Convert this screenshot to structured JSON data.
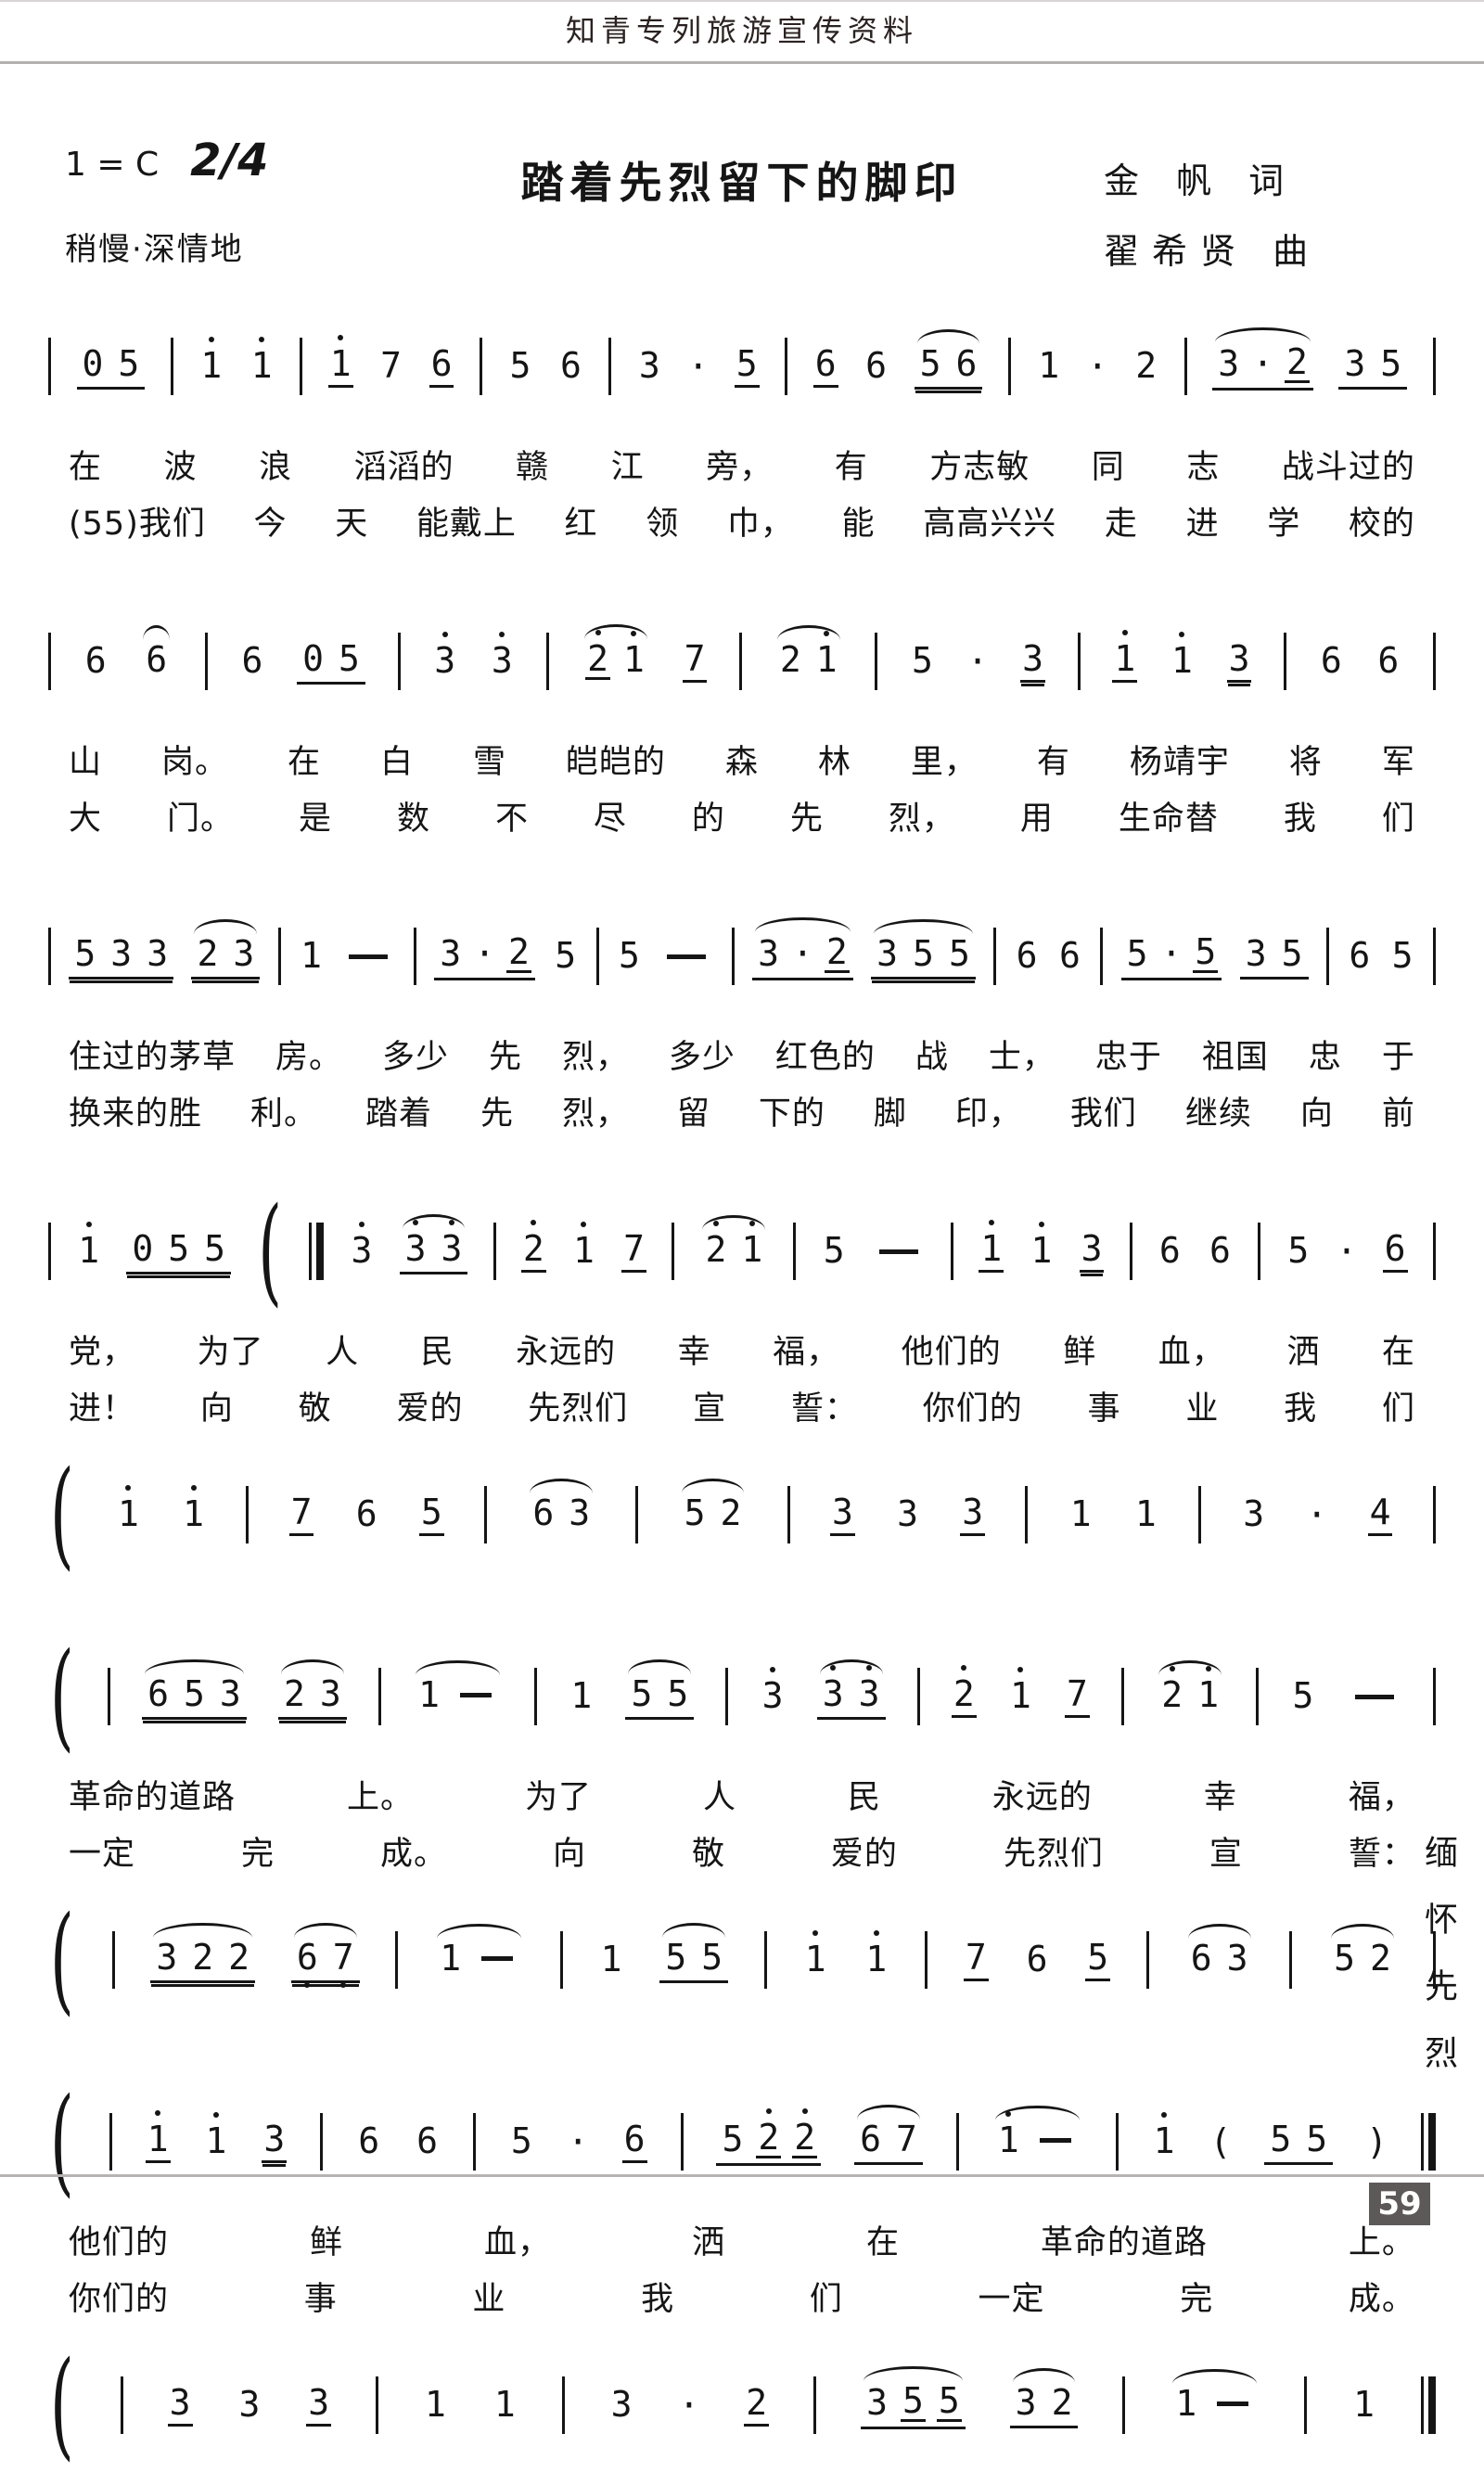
{
  "page": {
    "header": "知青专列旅游宣传资料",
    "margin_note": "缅怀先烈",
    "page_number": "59"
  },
  "colors": {
    "ink": "#151515",
    "rule_gray": "#b5b0b0",
    "page_number_bg": "#5e5959",
    "page_number_fg": "#ffffff"
  },
  "title_block": {
    "key": "1 = C",
    "meter": "2/4",
    "tempo": "稍慢·深情地",
    "title": "踏着先烈留下的脚印",
    "lyricist": "金 帆 词",
    "composer": "翟希贤 曲"
  },
  "systems": [
    {
      "voice1": [
        {
          "b": 1
        },
        {
          "g": [
            {
              "n": "0"
            },
            {
              "n": "5"
            }
          ],
          "u": 1
        },
        {
          "b": 1
        },
        {
          "n": "1",
          "o": 1
        },
        {
          "n": "1",
          "o": 1
        },
        {
          "b": 1
        },
        {
          "n": "1",
          "o": 1,
          "u": 1
        },
        {
          "n": "7"
        },
        {
          "n": "6",
          "u": 1
        },
        {
          "b": 1
        },
        {
          "n": "5"
        },
        {
          "n": "6"
        },
        {
          "b": 1
        },
        {
          "n": "3"
        },
        {
          "c": "·"
        },
        {
          "n": "5",
          "u": 1
        },
        {
          "b": 1
        },
        {
          "n": "6",
          "u": 1
        },
        {
          "n": "6"
        },
        {
          "g": [
            {
              "n": "5"
            },
            {
              "n": "6"
            }
          ],
          "u": 2,
          "arc": true
        },
        {
          "b": 1
        },
        {
          "n": "1"
        },
        {
          "c": "·"
        },
        {
          "n": "2"
        },
        {
          "b": 1
        },
        {
          "g": [
            {
              "n": "3"
            },
            {
              "c": "·"
            },
            {
              "n": "2",
              "u": 1
            }
          ],
          "u": 1,
          "arc": true
        },
        {
          "g": [
            {
              "n": "3"
            },
            {
              "n": "5"
            }
          ],
          "u": 1
        },
        {
          "b": 1
        }
      ],
      "lyrics1": [
        "在",
        "波",
        "浪",
        "滔滔的",
        "赣",
        "江",
        "旁，",
        "有",
        "方志敏",
        "同",
        "志",
        "战斗过的"
      ],
      "lyrics2": [
        "(55)我们",
        "今",
        "天",
        "能戴上",
        "红",
        "领",
        "巾，",
        "能",
        "高高兴兴",
        "走",
        "进",
        "学",
        "校的"
      ]
    },
    {
      "voice1": [
        {
          "b": 1
        },
        {
          "n": "6"
        },
        {
          "g": [
            {
              "n": "6"
            }
          ],
          "arc": true
        },
        {
          "b": 1
        },
        {
          "n": "6"
        },
        {
          "g": [
            {
              "n": "0"
            },
            {
              "n": "5"
            }
          ],
          "u": 1
        },
        {
          "b": 1
        },
        {
          "n": "3",
          "o": 1
        },
        {
          "n": "3",
          "o": 1
        },
        {
          "b": 1
        },
        {
          "g": [
            {
              "n": "2",
              "o": 1,
              "u": 1
            },
            {
              "n": "1",
              "o": 1
            }
          ],
          "arc": true
        },
        {
          "n": "7",
          "u": 1
        },
        {
          "b": 1
        },
        {
          "g": [
            {
              "n": "2"
            },
            {
              "n": "1",
              "o": 1
            }
          ],
          "arc": true
        },
        {
          "b": 1
        },
        {
          "n": "5"
        },
        {
          "c": "·"
        },
        {
          "n": "3",
          "u": 2
        },
        {
          "b": 1
        },
        {
          "n": "1",
          "o": 1,
          "u": 1
        },
        {
          "n": "1",
          "o": 1
        },
        {
          "n": "3",
          "u": 2
        },
        {
          "b": 1
        },
        {
          "n": "6"
        },
        {
          "n": "6"
        },
        {
          "b": 1
        }
      ],
      "lyrics1": [
        "山",
        "岗。",
        "在",
        "白",
        "雪",
        "皑皑的",
        "森",
        "林",
        "里，",
        "有",
        "杨靖宇",
        "将",
        "军"
      ],
      "lyrics2": [
        "大",
        "门。",
        "是",
        "数",
        "不",
        "尽",
        "的",
        "先",
        "烈，",
        "用",
        "生命替",
        "我",
        "们"
      ]
    },
    {
      "voice1": [
        {
          "b": 1
        },
        {
          "g": [
            {
              "n": "5"
            },
            {
              "n": "3"
            },
            {
              "n": "3"
            }
          ],
          "u": 2
        },
        {
          "g": [
            {
              "n": "2"
            },
            {
              "n": "3"
            }
          ],
          "u": 2,
          "arc": true
        },
        {
          "b": 1
        },
        {
          "n": "1"
        },
        {
          "d": 1
        },
        {
          "b": 1
        },
        {
          "g": [
            {
              "n": "3"
            },
            {
              "c": "·"
            },
            {
              "n": "2",
              "u": 1
            }
          ],
          "u": 1
        },
        {
          "n": "5"
        },
        {
          "b": 1
        },
        {
          "n": "5"
        },
        {
          "d": 1
        },
        {
          "b": 1
        },
        {
          "g": [
            {
              "n": "3"
            },
            {
              "c": "·"
            },
            {
              "n": "2",
              "u": 1
            }
          ],
          "u": 1,
          "arc": true
        },
        {
          "g": [
            {
              "n": "3"
            },
            {
              "n": "5"
            },
            {
              "n": "5"
            }
          ],
          "u": 2,
          "arc": true
        },
        {
          "b": 1
        },
        {
          "n": "6"
        },
        {
          "n": "6"
        },
        {
          "b": 1
        },
        {
          "g": [
            {
              "n": "5"
            },
            {
              "c": "·"
            },
            {
              "n": "5",
              "u": 1
            }
          ],
          "u": 1
        },
        {
          "g": [
            {
              "n": "3"
            },
            {
              "n": "5"
            }
          ],
          "u": 1
        },
        {
          "b": 1
        },
        {
          "n": "6"
        },
        {
          "n": "5"
        },
        {
          "b": 1
        }
      ],
      "lyrics1": [
        "住过的茅草",
        "房。",
        "多少",
        "先",
        "烈，",
        "多少",
        "红色的",
        "战",
        "士，",
        "忠于",
        "祖国",
        "忠",
        "于"
      ],
      "lyrics2": [
        "换来的胜",
        "利。",
        "踏着",
        "先",
        "烈，",
        "留",
        "下的",
        "脚",
        "印，",
        "我们",
        "继续",
        "向",
        "前"
      ]
    },
    {
      "voice1": [
        {
          "b": 1
        },
        {
          "n": "1",
          "o": 1
        },
        {
          "g": [
            {
              "n": "0"
            },
            {
              "n": "5"
            },
            {
              "n": "5"
            }
          ],
          "u": 2
        },
        {
          "br": 1
        },
        {
          "b": 2
        },
        {
          "n": "3",
          "o": 1
        },
        {
          "g": [
            {
              "n": "3",
              "o": 1
            },
            {
              "n": "3",
              "o": 1
            }
          ],
          "u": 1,
          "arc": true
        },
        {
          "b": 1
        },
        {
          "n": "2",
          "o": 1,
          "u": 1
        },
        {
          "n": "1",
          "o": 1
        },
        {
          "n": "7",
          "u": 1
        },
        {
          "b": 1
        },
        {
          "g": [
            {
              "n": "2",
              "o": 1
            },
            {
              "n": "1",
              "o": 1
            }
          ],
          "arc": true
        },
        {
          "b": 1
        },
        {
          "n": "5"
        },
        {
          "d": 1
        },
        {
          "b": 1
        },
        {
          "n": "1",
          "o": 1,
          "u": 1
        },
        {
          "n": "1",
          "o": 1
        },
        {
          "n": "3",
          "u": 2
        },
        {
          "b": 1
        },
        {
          "n": "6"
        },
        {
          "n": "6"
        },
        {
          "b": 1
        },
        {
          "n": "5"
        },
        {
          "c": "·"
        },
        {
          "n": "6",
          "u": 1
        },
        {
          "b": 1
        }
      ],
      "lyrics1": [
        "党，",
        "为了",
        "人",
        "民",
        "永远的",
        "幸",
        "福，",
        "他们的",
        "鲜",
        "血，",
        "洒",
        "在"
      ],
      "lyrics2": [
        "进！",
        "向",
        "敬",
        "爱的",
        "先烈们",
        "宣",
        "誓：",
        "你们的",
        "事",
        "业",
        "我",
        "们"
      ],
      "voice2": [
        {
          "br": 1
        },
        {
          "n": "1",
          "o": 1
        },
        {
          "n": "1",
          "o": 1
        },
        {
          "b": 1
        },
        {
          "n": "7",
          "u": 1
        },
        {
          "n": "6"
        },
        {
          "n": "5",
          "u": 1
        },
        {
          "b": 1
        },
        {
          "g": [
            {
              "n": "6"
            },
            {
              "n": "3"
            }
          ],
          "arc": true
        },
        {
          "b": 1
        },
        {
          "g": [
            {
              "n": "5"
            },
            {
              "n": "2"
            }
          ],
          "arc": true
        },
        {
          "b": 1
        },
        {
          "n": "3",
          "u": 1
        },
        {
          "n": "3"
        },
        {
          "n": "3",
          "u": 1
        },
        {
          "b": 1
        },
        {
          "n": "1"
        },
        {
          "n": "1"
        },
        {
          "b": 1
        },
        {
          "n": "3"
        },
        {
          "c": "·"
        },
        {
          "n": "4",
          "u": 1
        },
        {
          "b": 1
        }
      ]
    },
    {
      "voice1": [
        {
          "br": 1
        },
        {
          "b": 1
        },
        {
          "g": [
            {
              "n": "6"
            },
            {
              "n": "5"
            },
            {
              "n": "3"
            }
          ],
          "u": 2,
          "arc": true
        },
        {
          "g": [
            {
              "n": "2"
            },
            {
              "n": "3"
            }
          ],
          "u": 2,
          "arc": true
        },
        {
          "b": 1
        },
        {
          "g": [
            {
              "n": "1"
            },
            {
              "d": 1
            }
          ],
          "arc": true
        },
        {
          "b": 1
        },
        {
          "n": "1"
        },
        {
          "g": [
            {
              "n": "5"
            },
            {
              "n": "5"
            }
          ],
          "u": 1,
          "arc": true
        },
        {
          "b": 1
        },
        {
          "n": "3",
          "o": 1
        },
        {
          "g": [
            {
              "n": "3",
              "o": 1
            },
            {
              "n": "3",
              "o": 1
            }
          ],
          "u": 1,
          "arc": true
        },
        {
          "b": 1
        },
        {
          "n": "2",
          "o": 1,
          "u": 1
        },
        {
          "n": "1",
          "o": 1
        },
        {
          "n": "7",
          "u": 1
        },
        {
          "b": 1
        },
        {
          "g": [
            {
              "n": "2",
              "o": 1
            },
            {
              "n": "1",
              "o": 1
            }
          ],
          "arc": true
        },
        {
          "b": 1
        },
        {
          "n": "5"
        },
        {
          "d": 1
        },
        {
          "b": 1
        }
      ],
      "lyrics1": [
        "革命的道路",
        "上。",
        "为了",
        "人",
        "民",
        "永远的",
        "幸",
        "福，"
      ],
      "lyrics2": [
        "一定",
        "完",
        "成。",
        "向",
        "敬",
        "爱的",
        "先烈们",
        "宣",
        "誓："
      ],
      "voice2": [
        {
          "br": 1
        },
        {
          "b": 1
        },
        {
          "g": [
            {
              "n": "3"
            },
            {
              "n": "2"
            },
            {
              "n": "2"
            }
          ],
          "u": 2,
          "arc": true
        },
        {
          "g": [
            {
              "n": "6",
              "o": -1
            },
            {
              "n": "7",
              "o": -1
            }
          ],
          "u": 2,
          "arc": true
        },
        {
          "b": 1
        },
        {
          "g": [
            {
              "n": "1"
            },
            {
              "d": 1
            }
          ],
          "arc": true
        },
        {
          "b": 1
        },
        {
          "n": "1"
        },
        {
          "g": [
            {
              "n": "5"
            },
            {
              "n": "5"
            }
          ],
          "u": 1,
          "arc": true
        },
        {
          "b": 1
        },
        {
          "n": "1",
          "o": 1
        },
        {
          "n": "1",
          "o": 1
        },
        {
          "b": 1
        },
        {
          "n": "7",
          "u": 1
        },
        {
          "n": "6"
        },
        {
          "n": "5",
          "u": 1
        },
        {
          "b": 1
        },
        {
          "g": [
            {
              "n": "6"
            },
            {
              "n": "3"
            }
          ],
          "arc": true
        },
        {
          "b": 1
        },
        {
          "g": [
            {
              "n": "5"
            },
            {
              "n": "2"
            }
          ],
          "arc": true
        },
        {
          "b": 1
        }
      ]
    },
    {
      "voice1": [
        {
          "br": 1
        },
        {
          "b": 1
        },
        {
          "n": "1",
          "o": 1,
          "u": 1
        },
        {
          "n": "1",
          "o": 1
        },
        {
          "n": "3",
          "u": 2
        },
        {
          "b": 1
        },
        {
          "n": "6"
        },
        {
          "n": "6"
        },
        {
          "b": 1
        },
        {
          "n": "5"
        },
        {
          "c": "·"
        },
        {
          "n": "6",
          "u": 1
        },
        {
          "b": 1
        },
        {
          "g": [
            {
              "n": "5"
            },
            {
              "n": "2",
              "o": 1,
              "u": 1
            },
            {
              "n": "2",
              "o": 1,
              "u": 1
            }
          ],
          "u": 1
        },
        {
          "g": [
            {
              "n": "6"
            },
            {
              "n": "7"
            }
          ],
          "u": 1,
          "arc": true
        },
        {
          "b": 1
        },
        {
          "g": [
            {
              "n": "1",
              "o": 1
            },
            {
              "d": 1
            }
          ],
          "arc": true
        },
        {
          "b": 1
        },
        {
          "n": "1",
          "o": 1
        },
        {
          "c": "("
        },
        {
          "g": [
            {
              "n": "5"
            },
            {
              "n": "5"
            }
          ],
          "u": 1
        },
        {
          "c": ")"
        },
        {
          "b": 2
        }
      ],
      "lyrics1": [
        "他们的",
        "鲜",
        "血，",
        "洒",
        "在",
        "革命的道路",
        "上。"
      ],
      "lyrics2": [
        "你们的",
        "事",
        "业",
        "我",
        "们",
        "一定",
        "完",
        "成。"
      ],
      "voice2": [
        {
          "br": 1
        },
        {
          "b": 1
        },
        {
          "n": "3",
          "u": 1
        },
        {
          "n": "3"
        },
        {
          "n": "3",
          "u": 1
        },
        {
          "b": 1
        },
        {
          "n": "1"
        },
        {
          "n": "1"
        },
        {
          "b": 1
        },
        {
          "n": "3"
        },
        {
          "c": "·"
        },
        {
          "n": "2",
          "u": 1
        },
        {
          "b": 1
        },
        {
          "g": [
            {
              "n": "3"
            },
            {
              "n": "5",
              "u": 1
            },
            {
              "n": "5",
              "u": 1
            }
          ],
          "u": 1,
          "arc": true
        },
        {
          "g": [
            {
              "n": "3"
            },
            {
              "n": "2"
            }
          ],
          "u": 1,
          "arc": true
        },
        {
          "b": 1
        },
        {
          "g": [
            {
              "n": "1"
            },
            {
              "d": 1
            }
          ],
          "arc": true
        },
        {
          "b": 1
        },
        {
          "n": "1"
        },
        {
          "b": 2
        }
      ]
    }
  ]
}
